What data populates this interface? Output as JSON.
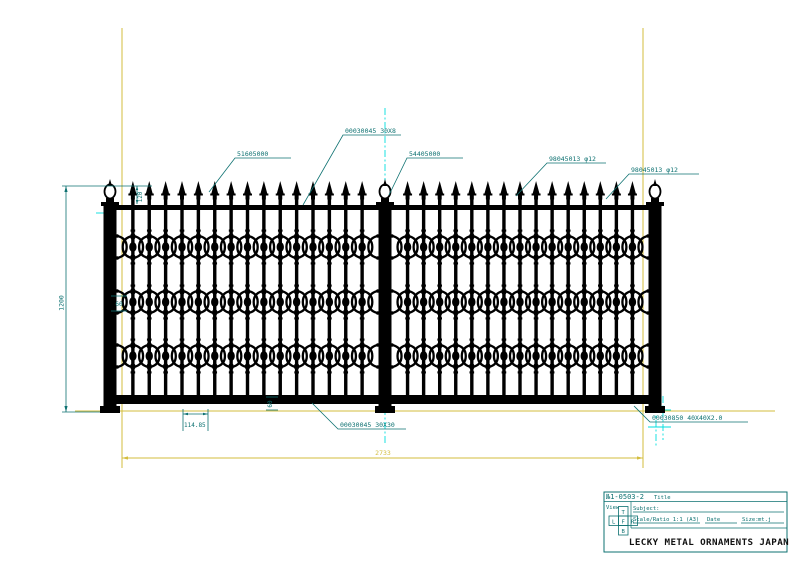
{
  "colors": {
    "teal": "#0d7171",
    "yellow": "#d3bd3e",
    "cyan": "#00dede",
    "ink": "#000000",
    "paper": "#ffffff"
  },
  "fence": {
    "panels": 2,
    "pickets_per_panel": 15,
    "ornament_rows": 3
  },
  "annotations": {
    "top_rail": "00030045 30X8",
    "picket_left": "51605000",
    "center_post": "54405000",
    "picket_right_1": "98045013 φ12",
    "picket_right_2": "98045013 φ12",
    "bottom_rail": "00030045 30X30",
    "end_post": "00030850 40X40X2.0"
  },
  "dimensions": {
    "overall_height": "1200",
    "finial_height": "120",
    "mid_gap": "60",
    "bottom_gap": "60",
    "picket_spacing": "114.85",
    "overall_width": "2733"
  },
  "title_block": {
    "drawing_no": "№1-0503-2",
    "title_label": "Title",
    "view_label": "View",
    "subject_label": "Subject:",
    "scale_label": "Scale/Ratio 1:1 (A3)",
    "date_label": "Date",
    "size_label": "Size:",
    "size_value": "mt.j",
    "company": "LECKY METAL ORNAMENTS JAPAN",
    "projection": {
      "top": "T",
      "left": "L",
      "front": "F",
      "right": "R",
      "bottom": "B"
    }
  }
}
